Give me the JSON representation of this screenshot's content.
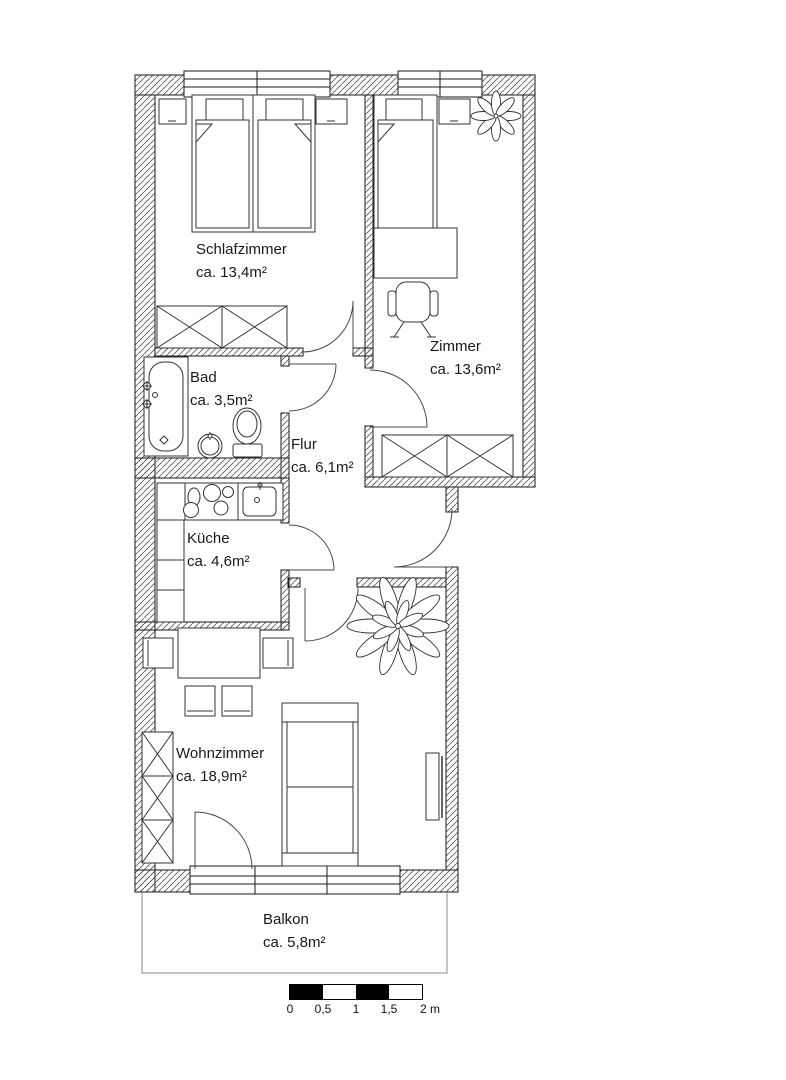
{
  "floor_plan": {
    "rooms": [
      {
        "id": "schlafzimmer",
        "name": "Schlafzimmer",
        "area": "ca. 13,4m²"
      },
      {
        "id": "zimmer",
        "name": "Zimmer",
        "area": "ca. 13,6m²"
      },
      {
        "id": "bad",
        "name": "Bad",
        "area": "ca. 3,5m²"
      },
      {
        "id": "flur",
        "name": "Flur",
        "area": "ca. 6,1m²"
      },
      {
        "id": "kueche",
        "name": "Küche",
        "area": "ca. 4,6m²"
      },
      {
        "id": "wohnzimmer",
        "name": "Wohnzimmer",
        "area": "ca. 18,9m²"
      },
      {
        "id": "balkon",
        "name": "Balkon",
        "area": "ca. 5,8m²"
      }
    ],
    "scale_bar": {
      "tick_labels": [
        "0",
        "0,5",
        "1",
        "1,5",
        "2 m"
      ]
    },
    "furniture_icons": [
      "double-bed",
      "single-bed",
      "nightstand",
      "wardrobe",
      "desk",
      "office-chair",
      "plant",
      "bathtub",
      "washbasin",
      "toilet",
      "stove",
      "kitchen-sink",
      "kitchen-counter",
      "dining-table",
      "dining-chair",
      "shelf",
      "sofa",
      "tv-board",
      "window",
      "door-swing"
    ],
    "colors": {
      "wall_line": "#1a1a1a",
      "hatch": "#555555",
      "scale_black": "#000000",
      "background": "#ffffff"
    }
  }
}
